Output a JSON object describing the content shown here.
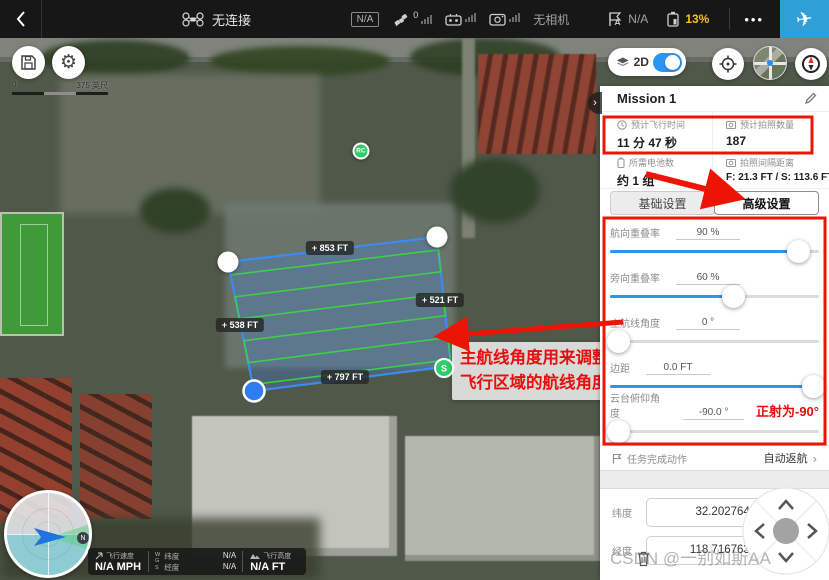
{
  "top_bar": {
    "aircraft_status": "无连接",
    "gps_badge": "N/A",
    "satellite_count": "0",
    "camera_status": "无相机",
    "flight_mode_value": "N/A",
    "battery_percent": "13%",
    "more_label": "•••"
  },
  "map": {
    "scale": {
      "start": "0",
      "end": "375 英尺"
    },
    "view_toggle_label": "2D",
    "rc_marker_label": "RC",
    "start_marker_label": "S",
    "north_badge": "N",
    "edge_labels": {
      "top": "+ 853 FT",
      "right": "+ 521 FT",
      "left": "+ 538 FT",
      "bottom": "+ 797 FT"
    },
    "annotation": {
      "line1": "主航线角度用来调整",
      "line2": "飞行区域的航线角度"
    }
  },
  "telemetry": {
    "speed_label": "飞行速度",
    "speed_value": "N/A MPH",
    "coord_system_w": "W",
    "coord_system_g": "G",
    "coord_system_s": "S",
    "lat_label": "纬度",
    "lat_value": "N/A",
    "lng_label": "经度",
    "lng_value": "N/A",
    "alt_label": "飞行高度",
    "alt_value": "N/A FT"
  },
  "panel": {
    "title": "Mission 1",
    "stats": [
      {
        "icon": "clock-icon",
        "label": "预计飞行时间",
        "value": "11 分 47 秒"
      },
      {
        "icon": "photo-count-icon",
        "label": "预计拍照数量",
        "value": "187"
      },
      {
        "icon": "battery-icon",
        "label": "所需电池数",
        "value": "约 1 组"
      },
      {
        "icon": "photo-interval-icon",
        "label": "拍照间隔距离",
        "value": "F: 21.3 FT / S: 113.6 FT"
      }
    ],
    "tabs": [
      {
        "label": "基础设置"
      },
      {
        "label": "高级设置"
      }
    ],
    "sliders": [
      {
        "label": "航向重叠率",
        "value": "90 %",
        "percent": 90
      },
      {
        "label": "旁向重叠率",
        "value": "60 %",
        "percent": 59
      },
      {
        "label": "主航线角度",
        "value": "0 °",
        "percent": 4
      },
      {
        "label": "边距",
        "value": "0.0 FT",
        "percent": 97
      },
      {
        "label": "云台俯仰角度",
        "value": "-90.0 °",
        "percent": 4,
        "note": "正射为-90°"
      }
    ],
    "finish_action": {
      "label": "任务完成动作",
      "value": "自动返航"
    },
    "coords": {
      "lat_label": "纬度",
      "lat_value": "32.202764195",
      "lng_label": "经度",
      "lng_value": "118.716763493"
    }
  },
  "watermark": "CSDN @一别如斯AA",
  "colors": {
    "accent_blue": "#2b95f3",
    "annotation_red": "#ec1505",
    "battery_yellow": "#f5c518",
    "route_green": "#3bd348",
    "area_blue": "#3d8bf2",
    "takeoff_button_blue": "#2f9fd7"
  }
}
